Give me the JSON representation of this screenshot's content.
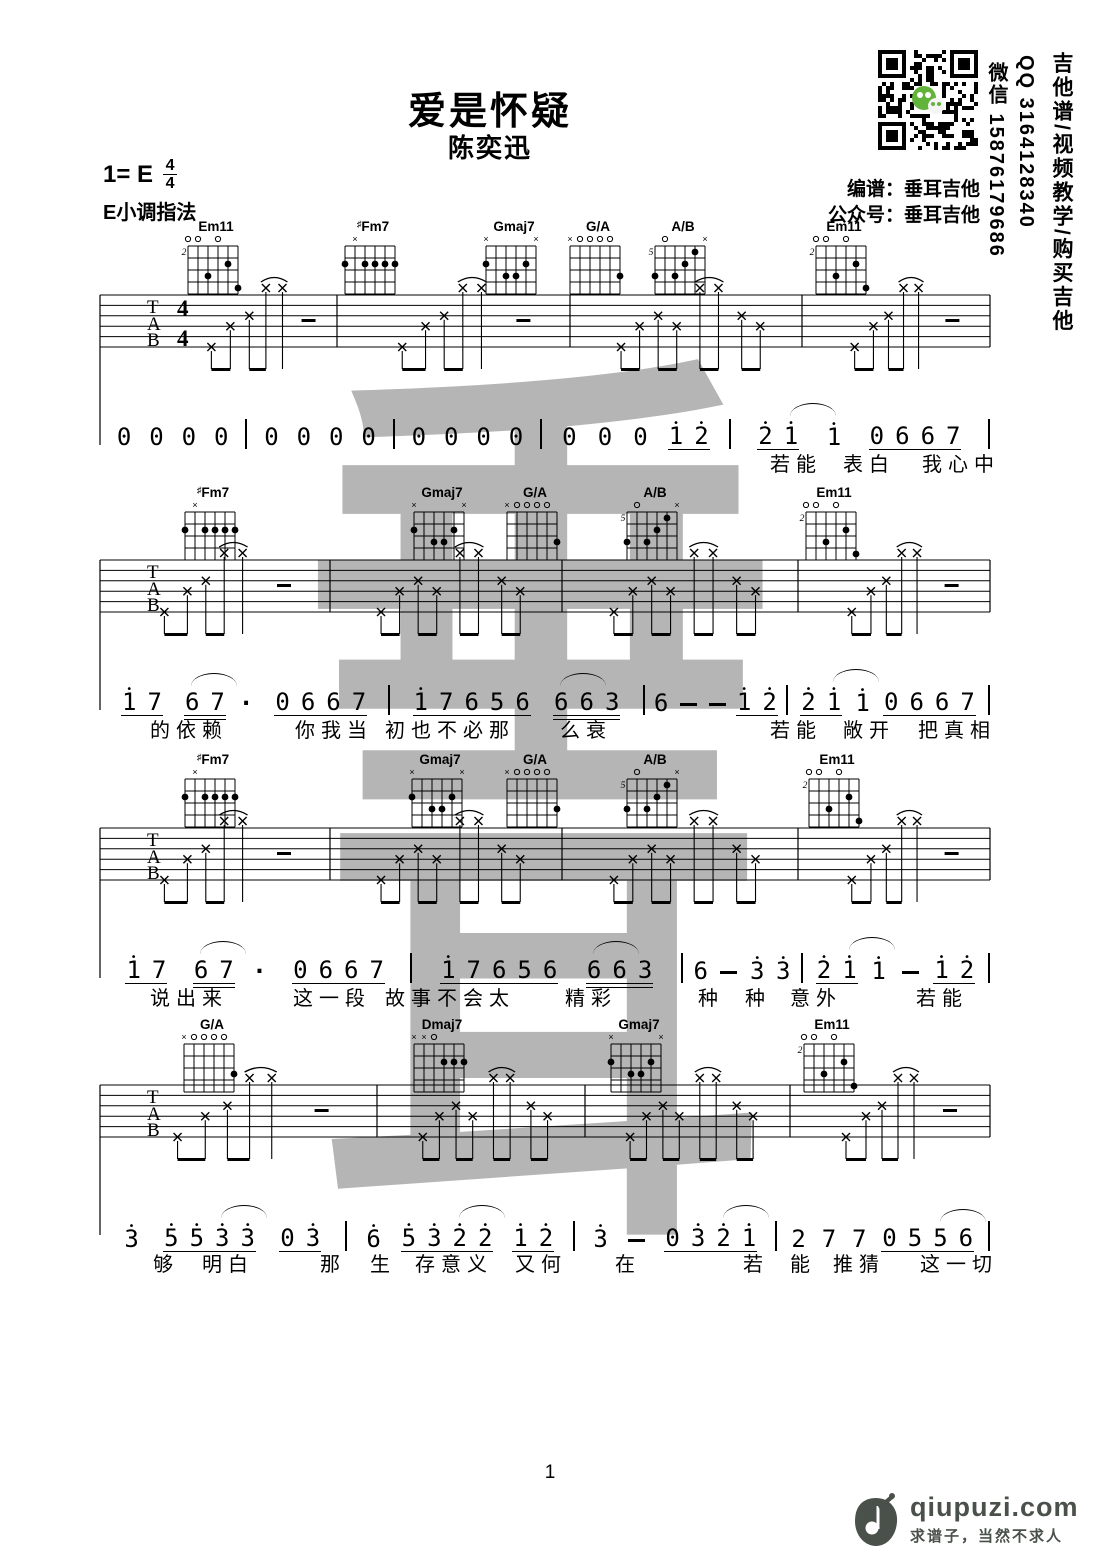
{
  "header": {
    "title": "爱是怀疑",
    "artist": "陈奕迅",
    "key_prefix": "1= E",
    "time_top": "4",
    "time_bottom": "4",
    "fingering": "E小调指法",
    "credit1": "编谱：垂耳吉他",
    "credit2": "公众号：垂耳吉他",
    "side_col1": "吉他谱/视频教学/购买吉他",
    "side_col2": "QQ 3164128340",
    "side_col3": "微信 15876179686"
  },
  "watermark": {
    "char1": "垂",
    "char2": "耳",
    "color": "#a9a9a9"
  },
  "tab_letters": [
    "T",
    "A",
    "B"
  ],
  "chord_lib": {
    "Em11": {
      "label": "Em11",
      "sharp": "",
      "pos": "2",
      "markers": [
        "o",
        "o",
        "",
        "o",
        "",
        ""
      ],
      "dots": [
        [
          2,
          2
        ],
        [
          4,
          3
        ],
        [
          1,
          4
        ]
      ]
    },
    "#Fm7": {
      "label": "Fm7",
      "sharp": "♯",
      "pos": "",
      "markers": [
        "",
        "x",
        "",
        "",
        "",
        ""
      ],
      "dots": [
        [
          6,
          2
        ],
        [
          4,
          2
        ],
        [
          3,
          2
        ],
        [
          2,
          2
        ],
        [
          1,
          2
        ]
      ]
    },
    "Gmaj7": {
      "label": "Gmaj7",
      "sharp": "",
      "pos": "",
      "markers": [
        "x",
        "",
        "",
        "",
        "",
        "x"
      ],
      "dots": [
        [
          6,
          2
        ],
        [
          2,
          2
        ],
        [
          4,
          3
        ],
        [
          3,
          3
        ]
      ]
    },
    "G/A": {
      "label": "G/A",
      "sharp": "",
      "pos": "",
      "markers": [
        "x",
        "o",
        "o",
        "o",
        "o",
        ""
      ],
      "dots": [
        [
          1,
          3
        ]
      ]
    },
    "A/B": {
      "label": "A/B",
      "sharp": "",
      "pos": "5",
      "markers": [
        "",
        "o",
        "",
        "",
        "",
        "x"
      ],
      "dots": [
        [
          2,
          1
        ],
        [
          3,
          2
        ],
        [
          6,
          3
        ],
        [
          4,
          3
        ]
      ]
    },
    "Dmaj7": {
      "label": "Dmaj7",
      "sharp": "",
      "pos": "",
      "markers": [
        "x",
        "x",
        "o",
        "",
        "",
        ""
      ],
      "dots": [
        [
          3,
          2
        ],
        [
          2,
          2
        ],
        [
          1,
          2
        ]
      ]
    }
  },
  "systems": [
    {
      "chordY": 218,
      "staffY": 295,
      "jianpuY": 414,
      "lyricY": 448,
      "timeSig": true,
      "bars": [
        100,
        337,
        570,
        802,
        990
      ],
      "patterns": [
        "A1",
        "A",
        "B",
        "A"
      ],
      "chords": [
        {
          "name": "Em11",
          "x": 188
        },
        {
          "name": "#Fm7",
          "x": 345
        },
        {
          "name": "Gmaj7",
          "x": 486
        },
        {
          "name": "G/A",
          "x": 570
        },
        {
          "name": "A/B",
          "x": 655
        },
        {
          "name": "Em11",
          "x": 816
        }
      ],
      "weights": [
        3,
        3,
        3,
        3.6,
        4
      ],
      "measures": [
        [
          {
            "t": "0"
          },
          {
            "t": "0"
          },
          {
            "t": "0"
          },
          {
            "t": "0"
          }
        ],
        [
          {
            "t": "0"
          },
          {
            "t": "0"
          },
          {
            "t": "0"
          },
          {
            "t": "0"
          }
        ],
        [
          {
            "t": "0"
          },
          {
            "t": "0"
          },
          {
            "t": "0"
          },
          {
            "t": "0"
          }
        ],
        [
          {
            "t": "0"
          },
          {
            "t": "0"
          },
          {
            "t": "0"
          },
          {
            "t": "1",
            "h": 1,
            "u": 1
          },
          {
            "t": "2",
            "h": 1,
            "u": 1
          }
        ],
        [
          {
            "t": "2",
            "h": 1,
            "u": 1
          },
          {
            "t": "1",
            "h": 1,
            "u": 1,
            "a": 1
          },
          {
            "t": "1",
            "h": 1
          },
          {
            "t": "0",
            "u": 1
          },
          {
            "t": "6",
            "u": 1
          },
          {
            "t": "6",
            "u": 1
          },
          {
            "t": "7",
            "u": 1
          }
        ]
      ],
      "lyrics": [
        [
          "若能",
          770
        ],
        [
          "表白",
          843
        ],
        [
          "我心中",
          922
        ]
      ]
    },
    {
      "chordY": 484,
      "staffY": 560,
      "jianpuY": 680,
      "lyricY": 714,
      "timeSig": false,
      "bars": [
        100,
        330,
        562,
        798,
        990
      ],
      "patterns": [
        "A",
        "B",
        "B",
        "A"
      ],
      "chords": [
        {
          "name": "#Fm7",
          "x": 185
        },
        {
          "name": "Gmaj7",
          "x": 414
        },
        {
          "name": "G/A",
          "x": 507
        },
        {
          "name": "A/B",
          "x": 627
        },
        {
          "name": "Em11",
          "x": 806
        }
      ],
      "weights": [
        4.1,
        2.6,
        1.6,
        1.9
      ],
      "measures": [
        [
          {
            "t": "1",
            "h": 1,
            "u": 1
          },
          {
            "t": "7",
            "u": 1
          },
          {
            "t": "6",
            "u": 2,
            "a": 1
          },
          {
            "t": "7",
            "u": 2
          },
          {
            "t": "."
          },
          {
            "t": "0",
            "u": 1
          },
          {
            "t": "6",
            "u": 1
          },
          {
            "t": "6",
            "u": 1
          },
          {
            "t": "7",
            "u": 1
          }
        ],
        [
          {
            "t": "1",
            "h": 1,
            "u": 1
          },
          {
            "t": "7",
            "u": 1
          },
          {
            "t": "6",
            "u": 1
          },
          {
            "t": "5",
            "u": 1
          },
          {
            "t": "6",
            "u": 1
          },
          {
            "t": "6",
            "u": 2,
            "a": 1
          },
          {
            "t": "6",
            "u": 2
          },
          {
            "t": "3",
            "u": 2
          }
        ],
        [
          {
            "t": "6"
          },
          {
            "t": "-"
          },
          {
            "t": "-"
          },
          {
            "t": "1",
            "h": 1,
            "u": 1
          },
          {
            "t": "2",
            "h": 1,
            "u": 1
          }
        ],
        [
          {
            "t": "2",
            "h": 1,
            "u": 1
          },
          {
            "t": "1",
            "h": 1,
            "u": 1,
            "a": 1
          },
          {
            "t": "1",
            "h": 1
          },
          {
            "t": "0",
            "u": 1
          },
          {
            "t": "6",
            "u": 1
          },
          {
            "t": "6",
            "u": 1
          },
          {
            "t": "7",
            "u": 1
          }
        ]
      ],
      "lyrics": [
        [
          "的依赖",
          150
        ],
        [
          "你我当",
          295
        ],
        [
          "初也不必那",
          385
        ],
        [
          "么衰",
          560
        ],
        [
          "若能",
          770
        ],
        [
          "敞开",
          843
        ],
        [
          "把真相",
          918
        ]
      ]
    },
    {
      "chordY": 751,
      "staffY": 828,
      "jianpuY": 948,
      "lyricY": 982,
      "timeSig": false,
      "bars": [
        100,
        330,
        562,
        798,
        990
      ],
      "patterns": [
        "A",
        "B",
        "B",
        "A"
      ],
      "chords": [
        {
          "name": "#Fm7",
          "x": 185
        },
        {
          "name": "Gmaj7",
          "x": 412
        },
        {
          "name": "G/A",
          "x": 507
        },
        {
          "name": "A/B",
          "x": 627
        },
        {
          "name": "Em11",
          "x": 809
        }
      ],
      "weights": [
        4.0,
        2.6,
        1.5,
        2.0
      ],
      "measures": [
        [
          {
            "t": "1",
            "h": 1,
            "u": 1
          },
          {
            "t": "7",
            "u": 1
          },
          {
            "t": "6",
            "u": 2,
            "a": 1
          },
          {
            "t": "7",
            "u": 2
          },
          {
            "t": "."
          },
          {
            "t": "0",
            "u": 1
          },
          {
            "t": "6",
            "u": 1
          },
          {
            "t": "6",
            "u": 1
          },
          {
            "t": "7",
            "u": 1
          }
        ],
        [
          {
            "t": "1",
            "h": 1,
            "u": 1
          },
          {
            "t": "7",
            "u": 1
          },
          {
            "t": "6",
            "u": 1
          },
          {
            "t": "5",
            "u": 1
          },
          {
            "t": "6",
            "u": 1
          },
          {
            "t": "6",
            "u": 2,
            "a": 1
          },
          {
            "t": "6",
            "u": 2
          },
          {
            "t": "3",
            "u": 2
          }
        ],
        [
          {
            "t": "6"
          },
          {
            "t": "-"
          },
          {
            "t": "3",
            "h": 1
          },
          {
            "t": "3",
            "h": 1
          }
        ],
        [
          {
            "t": "2",
            "h": 1,
            "u": 1
          },
          {
            "t": "1",
            "h": 1,
            "u": 1,
            "a": 1
          },
          {
            "t": "1",
            "h": 1
          },
          {
            "t": "-"
          },
          {
            "t": "1",
            "h": 1,
            "u": 1
          },
          {
            "t": "2",
            "h": 1,
            "u": 1
          }
        ]
      ],
      "lyrics": [
        [
          "说出来",
          150
        ],
        [
          "这一段",
          293
        ],
        [
          "故事不会太",
          385
        ],
        [
          "精彩",
          565
        ],
        [
          "种",
          698
        ],
        [
          "种",
          745
        ],
        [
          "意外",
          790
        ],
        [
          "若能",
          916
        ]
      ]
    },
    {
      "chordY": 1016,
      "staffY": 1085,
      "jianpuY": 1216,
      "lyricY": 1248,
      "timeSig": false,
      "bars": [
        100,
        377,
        585,
        790,
        990
      ],
      "patterns": [
        "A",
        "B",
        "B",
        "A"
      ],
      "chords": [
        {
          "name": "G/A",
          "x": 184
        },
        {
          "name": "Dmaj7",
          "x": 414
        },
        {
          "name": "Gmaj7",
          "x": 611
        },
        {
          "name": "Em11",
          "x": 804
        }
      ],
      "weights": [
        3.1,
        2.5,
        2.3,
        2.3
      ],
      "measures": [
        [
          {
            "t": "3",
            "h": 1
          },
          {
            "t": "5",
            "h": 1,
            "u": 1
          },
          {
            "t": "5",
            "h": 1,
            "u": 1
          },
          {
            "t": "3",
            "h": 1,
            "u": 1,
            "a": 1
          },
          {
            "t": "3",
            "h": 1,
            "u": 1
          },
          {
            "t": "0",
            "u": 1,
            "brk": 1
          },
          {
            "t": "3",
            "h": 1,
            "u": 1
          }
        ],
        [
          {
            "t": "6",
            "h": 1
          },
          {
            "t": "5",
            "h": 1,
            "u": 1
          },
          {
            "t": "3",
            "h": 1,
            "u": 1
          },
          {
            "t": "2",
            "h": 1,
            "u": 1,
            "a": 1
          },
          {
            "t": "2",
            "h": 1,
            "u": 1
          },
          {
            "t": "1",
            "h": 1,
            "u": 1,
            "brk": 1
          },
          {
            "t": "2",
            "h": 1,
            "u": 1
          }
        ],
        [
          {
            "t": "3",
            "h": 1
          },
          {
            "t": "-"
          },
          {
            "t": "0",
            "u": 1
          },
          {
            "t": "3",
            "h": 1,
            "u": 1
          },
          {
            "t": "2",
            "h": 1,
            "u": 1,
            "a": 1
          },
          {
            "t": "1",
            "h": 1,
            "u": 1
          }
        ],
        [
          {
            "t": "2"
          },
          {
            "t": "7"
          },
          {
            "t": "7"
          },
          {
            "t": "0",
            "u": 1
          },
          {
            "t": "5",
            "u": 1
          },
          {
            "t": "5",
            "u": 1,
            "a": 1
          },
          {
            "t": "6",
            "u": 1
          }
        ]
      ],
      "lyrics": [
        [
          "够",
          153
        ],
        [
          "明白",
          202
        ],
        [
          "那",
          320
        ],
        [
          "生",
          370
        ],
        [
          "存意义",
          415
        ],
        [
          "又何",
          515
        ],
        [
          "在",
          615
        ],
        [
          "若",
          743
        ],
        [
          "能",
          790
        ],
        [
          "推猜",
          833
        ],
        [
          "这一切",
          920
        ]
      ]
    }
  ],
  "footer": {
    "page": "1",
    "site": "qiupuzi.com",
    "slogan": "求谱子，当然不求人"
  }
}
